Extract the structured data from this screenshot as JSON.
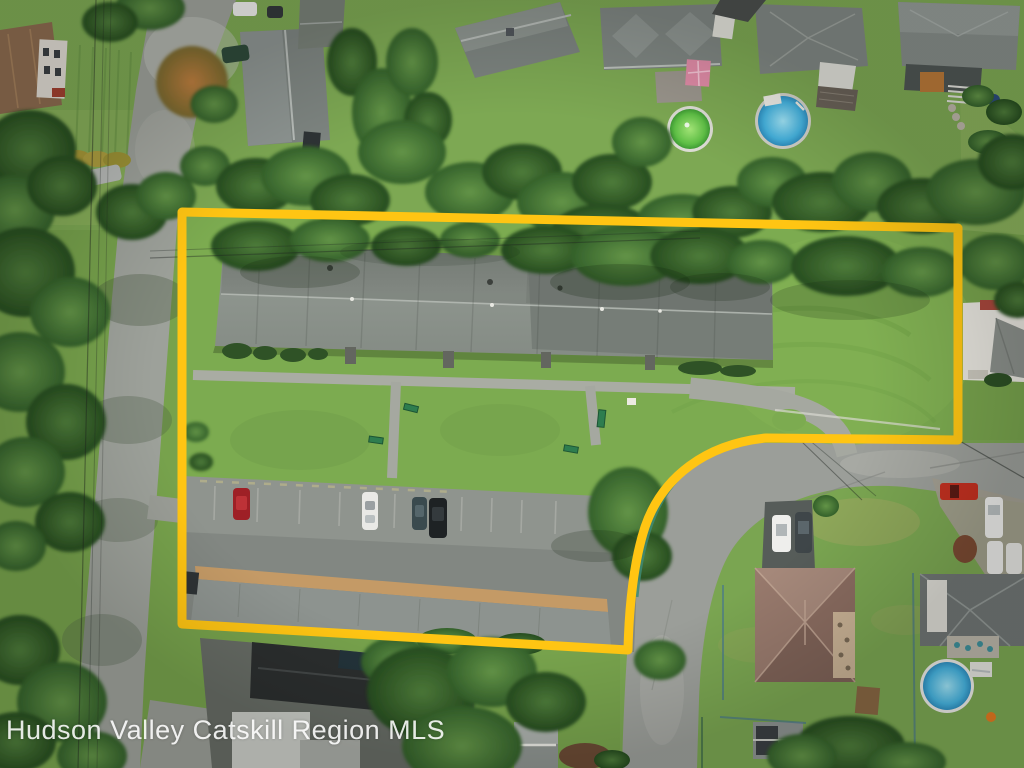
{
  "watermark": {
    "text": "Hudson Valley Catskill Region MLS"
  },
  "colors": {
    "boundary": "#FFC513",
    "watermark": "#FFFFFF",
    "grass": "#77A24C",
    "parcel_lawn": "#7CAB50",
    "road": "#9DA19A",
    "asphalt": "#8F948E",
    "main_roof": "#868D86",
    "storage_roof_trim": "#C49A66",
    "pool_green": "#5FC046",
    "pool_blue": "#45B2DE",
    "guardrail": "#3E8A74"
  },
  "scene": {
    "type": "aerial-drone-photo",
    "subject": "residential parcel outlined in yellow containing a long single-story multi-unit building, lawns, a parking lot with four cars, and a long storage building",
    "surroundings": "neighborhood houses with two above-ground pools at top, tree-lined street on the left, curving street at lower right, houses with backyard pool at bottom right",
    "highlight": "yellow property-boundary outline",
    "vehicle_colors_in_lot": [
      "red",
      "white",
      "dark-teal",
      "black"
    ]
  }
}
